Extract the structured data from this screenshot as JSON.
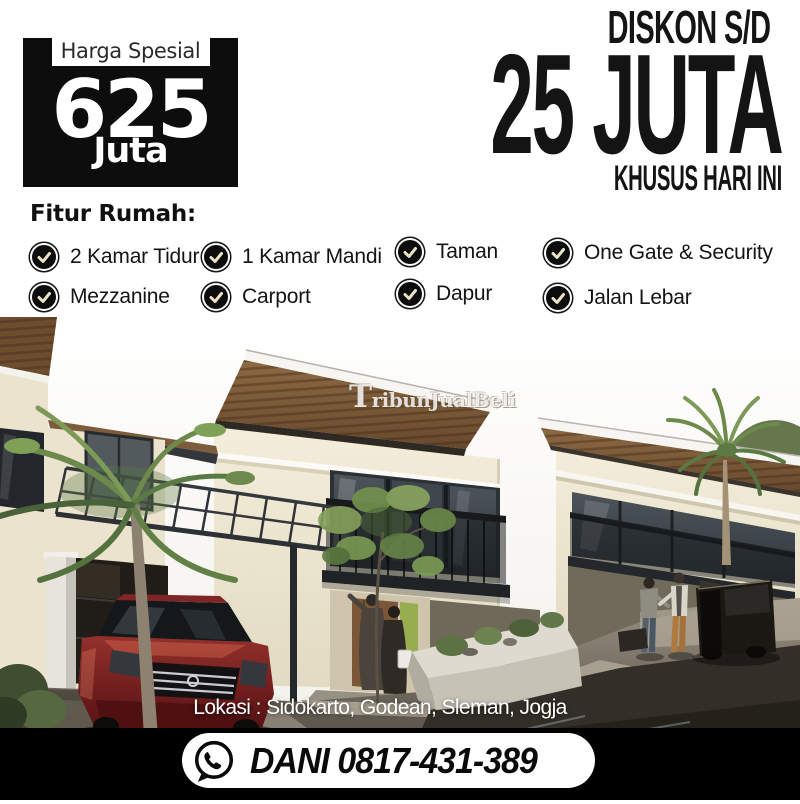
{
  "badge": {
    "label": "Harga Spesial",
    "price": "625",
    "unit": "Juta"
  },
  "discount": {
    "line1": "DISKON S/D",
    "line2": "25 JUTA",
    "line3": "KHUSUS HARI INI"
  },
  "features": {
    "heading": "Fitur Rumah:",
    "items": [
      {
        "icon": "check-icon",
        "label": "2 Kamar Tidur"
      },
      {
        "icon": "check-icon",
        "label": "1 Kamar Mandi"
      },
      {
        "icon": "check-icon",
        "label": "Taman"
      },
      {
        "icon": "check-icon",
        "label": "One Gate & Security"
      },
      {
        "icon": "check-icon",
        "label": "Mezzanine"
      },
      {
        "icon": "check-icon",
        "label": "Carport"
      },
      {
        "icon": "check-icon",
        "label": "Dapur"
      },
      {
        "icon": "check-icon",
        "label": "Jalan Lebar"
      }
    ]
  },
  "photo": {
    "watermark": "TribunJualBeli",
    "location_caption": "Lokasi : Sidokarto, Godean, Sleman, Jogja",
    "alt": "3D render of modern minimalist two-storey houses with wood-clad flat roofs, carport pergola, maroon sedan, palm trees, people and wet driveway"
  },
  "contact": {
    "phone_label": "DANI 0817-431-389",
    "icon": "whatsapp-icon"
  },
  "colors": {
    "badge_bg": "#0d0d0d",
    "headline_text": "#141414",
    "check_mark": "#ece3c4",
    "wall_cream": "#efe8d5",
    "roof_wood": "#7a5a38",
    "bottom_band": "#000000",
    "pill_bg": "#ffffff"
  }
}
